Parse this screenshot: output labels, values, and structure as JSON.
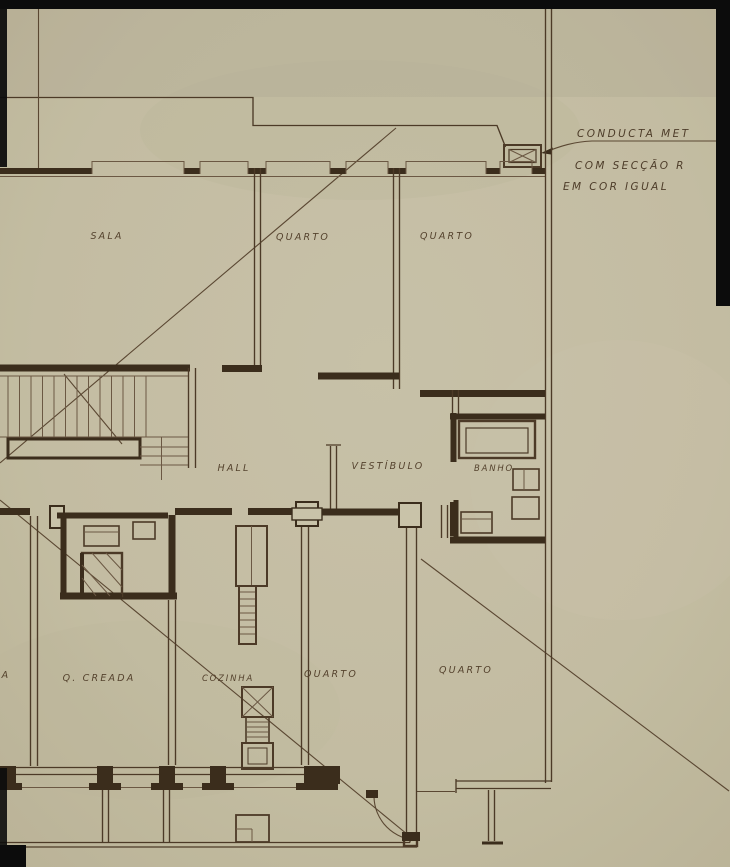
{
  "drawing": {
    "rooms": {
      "sala": "SALA",
      "quarto_top_left": "QUARTO",
      "quarto_top_right": "QUARTO",
      "hall": "HALL",
      "vestibulo": "VESTÍBULO",
      "banho": "BANHO",
      "quarto_creada": "Q. CREADA",
      "cozinha": "COZINHA",
      "quarto_bottom_left": "QUARTO",
      "quarto_bottom_right": "QUARTO",
      "edge_label_fragment": "A"
    },
    "annotation": {
      "line1": "CONDUCTA MET",
      "line2": "COM SECÇÃO R",
      "line3": "EM COR IGUAL"
    },
    "colors": {
      "paper": "#c9c3a9",
      "ink": "#5a4732",
      "ink_dark": "#3b2d1c",
      "scan_edge": "#0c0c0c"
    }
  }
}
